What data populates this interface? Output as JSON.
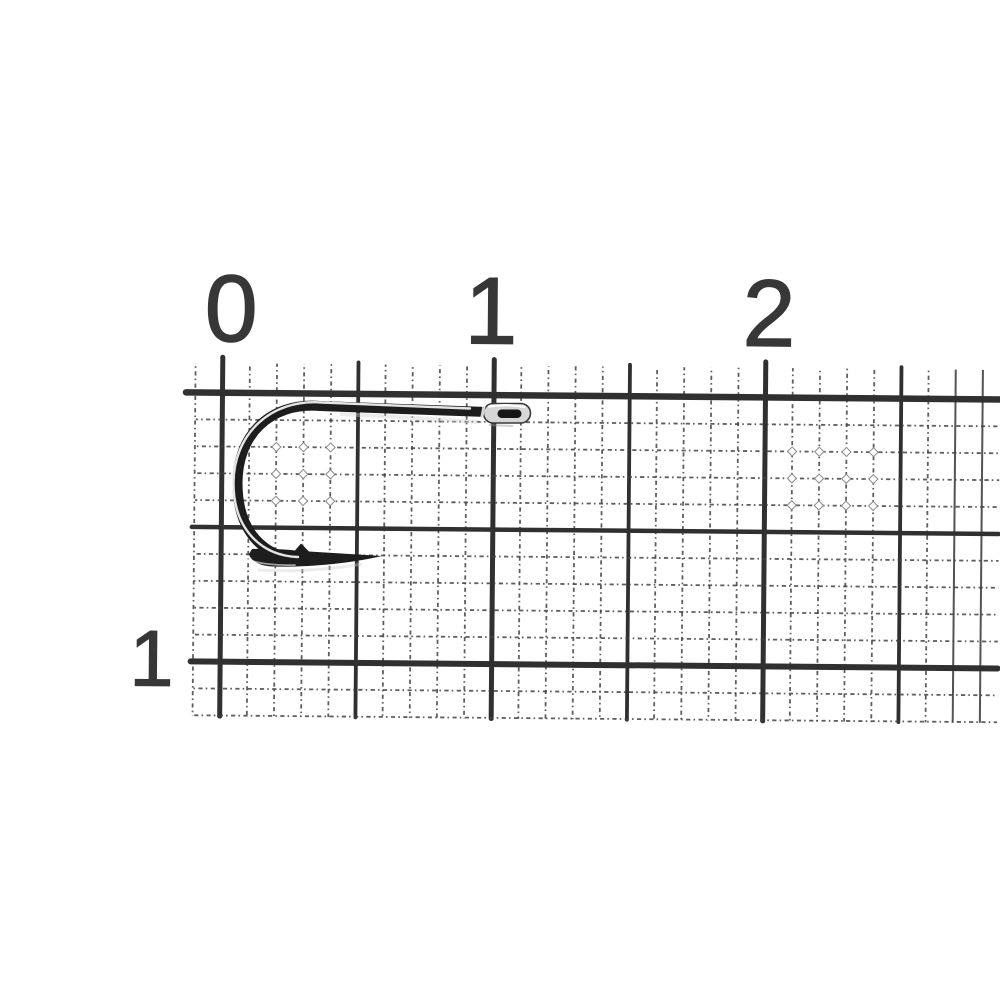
{
  "photo": {
    "subject": "fishing-hook-on-millimeter-ruler-paper",
    "background_color": "#ffffff"
  },
  "ruler": {
    "top_scale_labels": [
      "0",
      "1",
      "2"
    ],
    "left_scale_labels": [
      "1"
    ],
    "major_line_color": "#303030",
    "minor_line_color": "#424242",
    "sparkle_rim_color": "#8a8a8a",
    "label_color": "#373737"
  },
  "hook": {
    "body_color": "#1d1d1d",
    "highlight_color": "#f5f5f5",
    "eye_metal_color": "#d6d6d6",
    "eye_hole_color": "#161616",
    "shadow_color": "#cfcfcf"
  }
}
